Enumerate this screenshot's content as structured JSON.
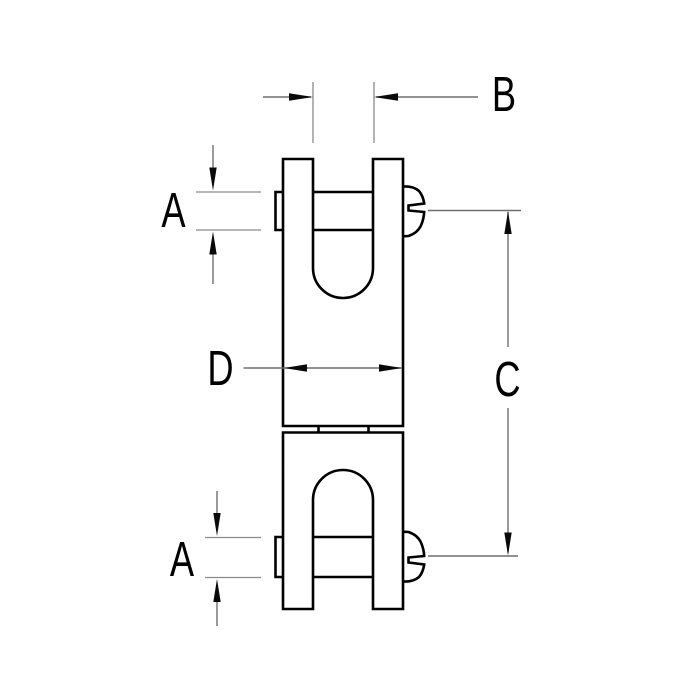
{
  "page": {
    "background_color": "#ffffff"
  },
  "diagram": {
    "kind": "technical line drawing",
    "subject": "double-jaw swivel fitting, side view with dimension callouts",
    "outline_color": "#000000",
    "dimension_line_color": "#6f6f6f",
    "label_color": "#000000",
    "labels": {
      "dim_a_top": "A",
      "dim_b": "B",
      "dim_c": "C",
      "dim_d": "D",
      "dim_a_bottom": "A"
    }
  }
}
